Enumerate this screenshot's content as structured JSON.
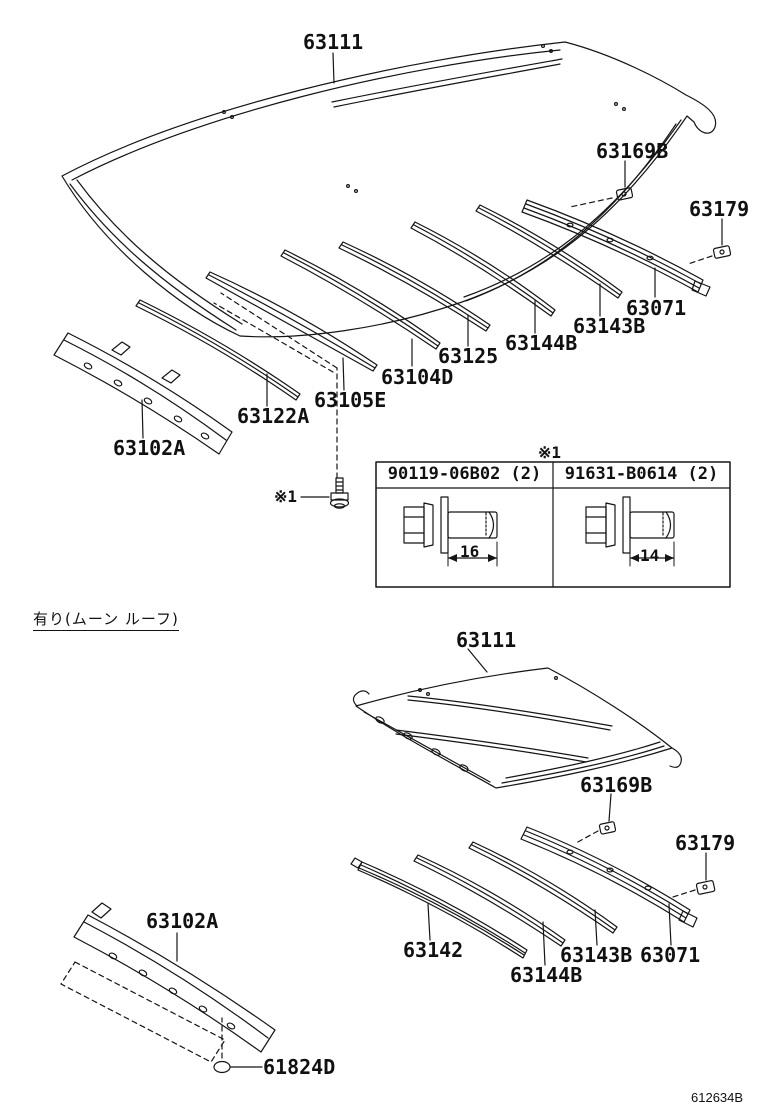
{
  "page": {
    "background": "#ffffff",
    "ink": "#151515",
    "doc_number": "612634B"
  },
  "ref_marker": "※1",
  "moonroof_note": "有り(ムーン ルーフ)",
  "top_section": {
    "roof_panel": "63111",
    "clip": "63169B",
    "retainer": "63179",
    "bows": {
      "reinf_rear": "63071",
      "bow_4": "63143B",
      "bow_3": "63144B",
      "bow_2": "63125",
      "bow_1": "63104D",
      "front_sub": "63105E",
      "front_reinf": "63122A",
      "windshield_header": "63102A"
    }
  },
  "fastener_table": {
    "columns": [
      {
        "part_number": "90119-06B02 (2)",
        "shank_length": "16"
      },
      {
        "part_number": "91631-B0614 (2)",
        "shank_length": "14"
      }
    ]
  },
  "bottom_section": {
    "roof_panel": "63111",
    "clip": "63169B",
    "retainer": "63179",
    "bow_1": "63142",
    "bow_2": "63144B",
    "bow_3": "63143B",
    "bow_4": "63071",
    "windshield_header": "63102A",
    "plug": "61824D"
  }
}
